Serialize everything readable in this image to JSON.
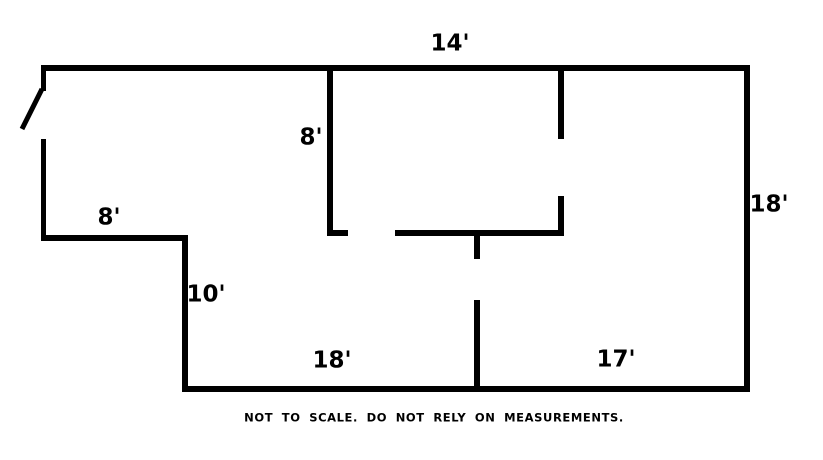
{
  "diagram": {
    "type": "floor-plan",
    "background_color": "#ffffff",
    "wall_color": "#000000",
    "disclaimer": "NOT TO SCALE. DO NOT RELY ON MEASUREMENTS.",
    "disclaimer_pos": {
      "x": 434,
      "y": 418
    },
    "labels": [
      {
        "name": "top-width",
        "text": "14'",
        "x": 450,
        "y": 44
      },
      {
        "name": "middle-wall-height",
        "text": "8'",
        "x": 311,
        "y": 138
      },
      {
        "name": "left-wing-width",
        "text": "8'",
        "x": 109,
        "y": 218
      },
      {
        "name": "left-step-height",
        "text": "10'",
        "x": 206,
        "y": 295
      },
      {
        "name": "bottom-left-width",
        "text": "18'",
        "x": 332,
        "y": 361
      },
      {
        "name": "bottom-right-width",
        "text": "17'",
        "x": 616,
        "y": 360
      },
      {
        "name": "right-wall-height",
        "text": "18'",
        "x": 769,
        "y": 205
      }
    ],
    "walls": [
      {
        "name": "top-wall",
        "x": 41,
        "y": 65,
        "w": 709,
        "h": 6
      },
      {
        "name": "right-wall",
        "x": 744,
        "y": 65,
        "w": 6,
        "h": 327
      },
      {
        "name": "bottom-wall",
        "x": 182,
        "y": 386,
        "w": 568,
        "h": 6
      },
      {
        "name": "left-wall-upper-stub",
        "x": 41,
        "y": 65,
        "w": 5,
        "h": 26
      },
      {
        "name": "left-wall-lower",
        "x": 41,
        "y": 139,
        "w": 5,
        "h": 102
      },
      {
        "name": "left-wing-bottom-wall",
        "x": 41,
        "y": 235,
        "w": 147,
        "h": 6
      },
      {
        "name": "left-step-wall",
        "x": 182,
        "y": 235,
        "w": 6,
        "h": 157
      },
      {
        "name": "middle-interior-wall",
        "x": 327,
        "y": 65,
        "w": 6,
        "h": 171
      },
      {
        "name": "middle-wall-bottom-stub",
        "x": 327,
        "y": 230,
        "w": 21,
        "h": 6
      },
      {
        "name": "interior-horizontal-wall",
        "x": 395,
        "y": 230,
        "w": 169,
        "h": 6
      },
      {
        "name": "right-interior-wall-upper",
        "x": 558,
        "y": 65,
        "w": 6,
        "h": 74
      },
      {
        "name": "right-interior-wall-lower",
        "x": 558,
        "y": 196,
        "w": 6,
        "h": 40
      },
      {
        "name": "hallway-stub-wall",
        "x": 474,
        "y": 233,
        "w": 6,
        "h": 26
      },
      {
        "name": "lower-interior-wall",
        "x": 474,
        "y": 300,
        "w": 6,
        "h": 92
      }
    ],
    "door": {
      "x1": 42,
      "y1": 89,
      "x2": 22,
      "y2": 129,
      "stroke_width": 5
    }
  }
}
